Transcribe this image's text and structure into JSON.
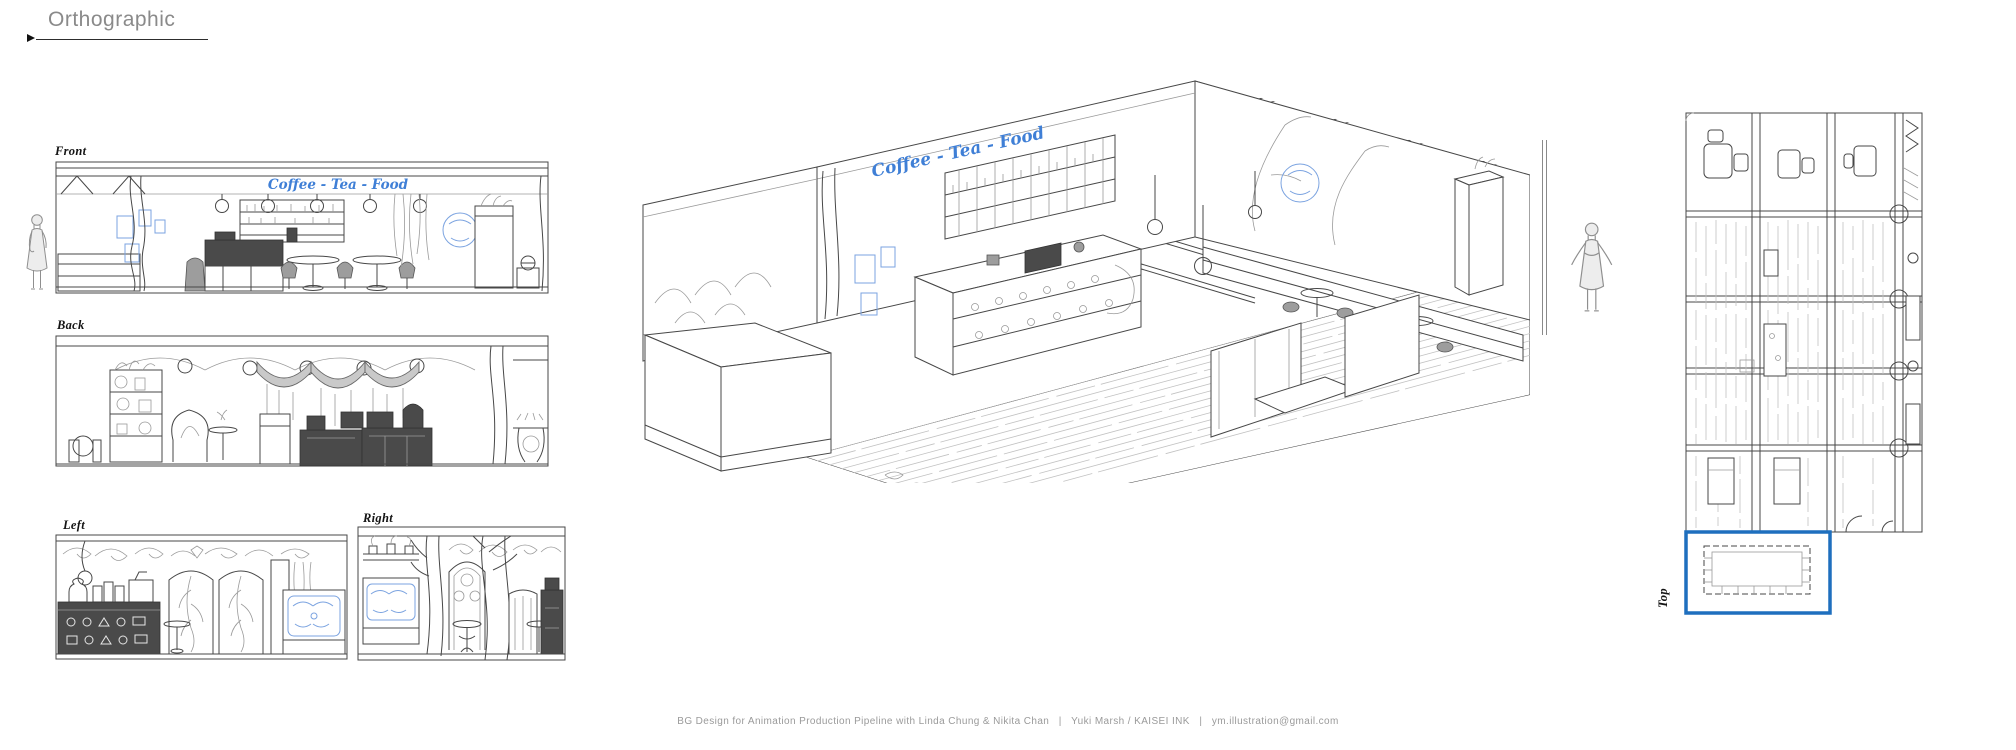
{
  "header": {
    "title": "Orthographic"
  },
  "views": {
    "front": {
      "label": "Front"
    },
    "back": {
      "label": "Back"
    },
    "left": {
      "label": "Left"
    },
    "right": {
      "label": "Right"
    },
    "top": {
      "label": "Top"
    }
  },
  "sign": {
    "text": "Coffee - Tea - Food"
  },
  "footer": {
    "credit": "BG Design for Animation Production Pipeline with Linda Chung & Nikita Chan   |   Yuki Marsh / KAISEI INK   |   ym.illustration@gmail.com"
  },
  "colors": {
    "ink": "#474747",
    "sketch_blue": "#7ba3e0",
    "sign_blue": "#3f7fd6",
    "highlight_blue": "#1e6fbe",
    "shade_gray": "#c9c9c9",
    "dark_furniture": "#4a4a4a"
  }
}
